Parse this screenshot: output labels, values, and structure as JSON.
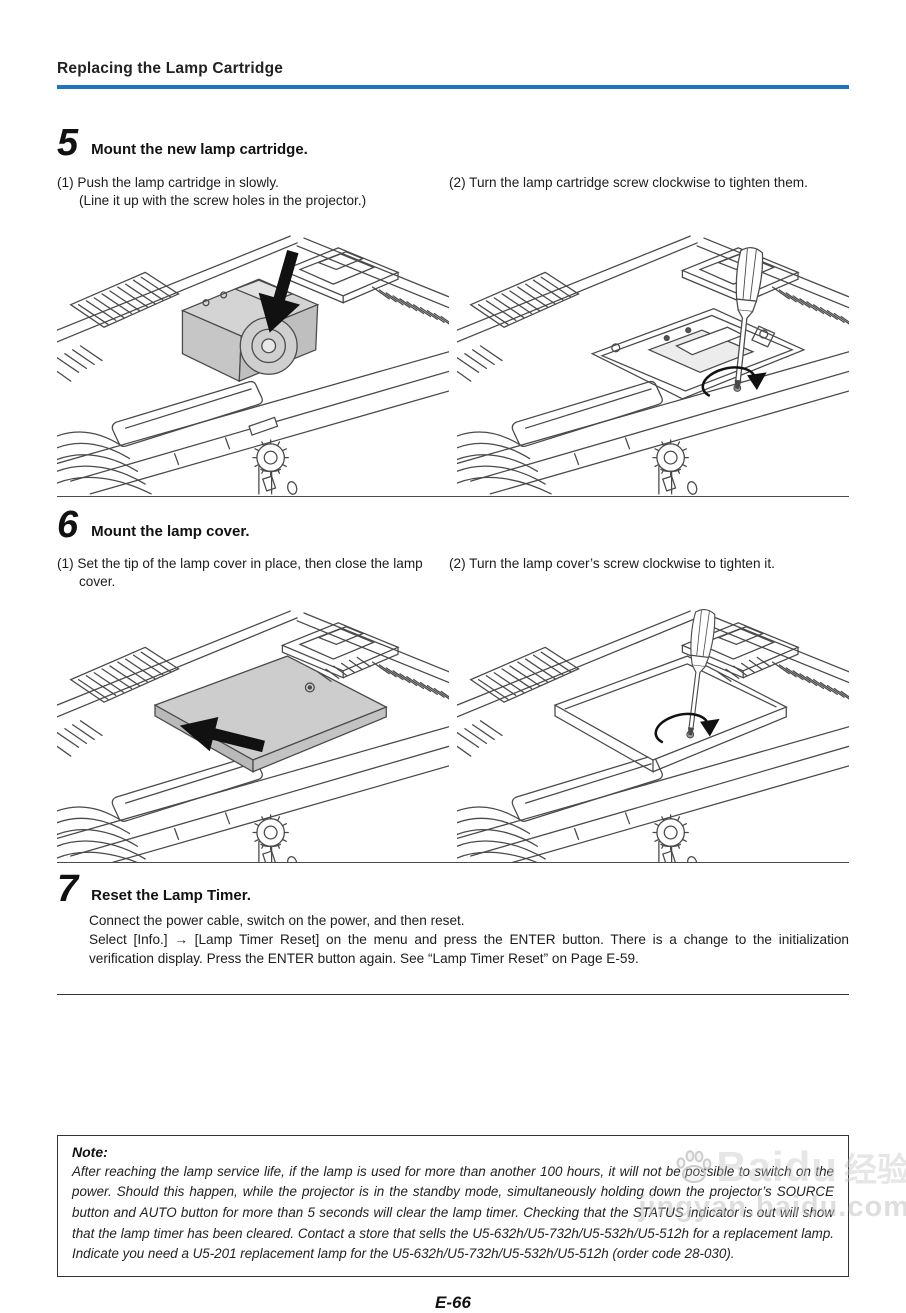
{
  "page": {
    "header_title": "Replacing the Lamp Cartridge",
    "page_number": "E-66"
  },
  "colors": {
    "accent_blue": "#1d74c0",
    "line_art": "#4a4a4a",
    "cover_gray": "#cdcdcd"
  },
  "steps": [
    {
      "number": "5",
      "title": "Mount the new lamp cartridge.",
      "items": [
        {
          "label": "(1)",
          "text": "Push the lamp cartridge in slowly.",
          "sub": "(Line it up with the screw holes in the projector.)"
        },
        {
          "label": "(2)",
          "text": "Turn the lamp cartridge screw clockwise to tighten them."
        }
      ],
      "figures": [
        "push-lamp-cartridge-illustration",
        "tighten-cartridge-screw-illustration"
      ]
    },
    {
      "number": "6",
      "title": "Mount the lamp cover.",
      "items": [
        {
          "label": "(1)",
          "text": "Set the tip of the lamp cover in place, then close the lamp cover."
        },
        {
          "label": "(2)",
          "text": "Turn the lamp cover’s screw clockwise to tighten it."
        }
      ],
      "figures": [
        "close-lamp-cover-illustration",
        "tighten-cover-screw-illustration"
      ]
    },
    {
      "number": "7",
      "title": "Reset the Lamp Timer.",
      "lines": [
        "Connect the power cable, switch on the power, and then reset.",
        "Select [Info.] → [Lamp Timer Reset] on the menu and press the ENTER button. There is a change to the initialization verification display. Press the ENTER button again. See “Lamp Timer Reset” on Page E-59."
      ]
    }
  ],
  "note": {
    "label": "Note:",
    "text": "After reaching the lamp service life, if the lamp is used for more than another 100 hours, it will not be possible to switch on the power. Should this happen, while the projector is in the standby mode, simultaneously holding down the projector’s SOURCE button and AUTO button for more than 5 seconds will clear the lamp timer. Checking that the STATUS indicator is out will show that the lamp timer has been cleared. Contact a store that sells the U5-632h/U5-732h/U5-532h/U5-512h for a replacement lamp. Indicate you need a U5-201 replacement lamp for the U5-632h/U5-732h/U5-532h/U5-512h (order code 28-030)."
  },
  "watermark": {
    "logo_text": "Baidu",
    "logo_cn": "经验",
    "url": "jingyan.baidu.com"
  }
}
